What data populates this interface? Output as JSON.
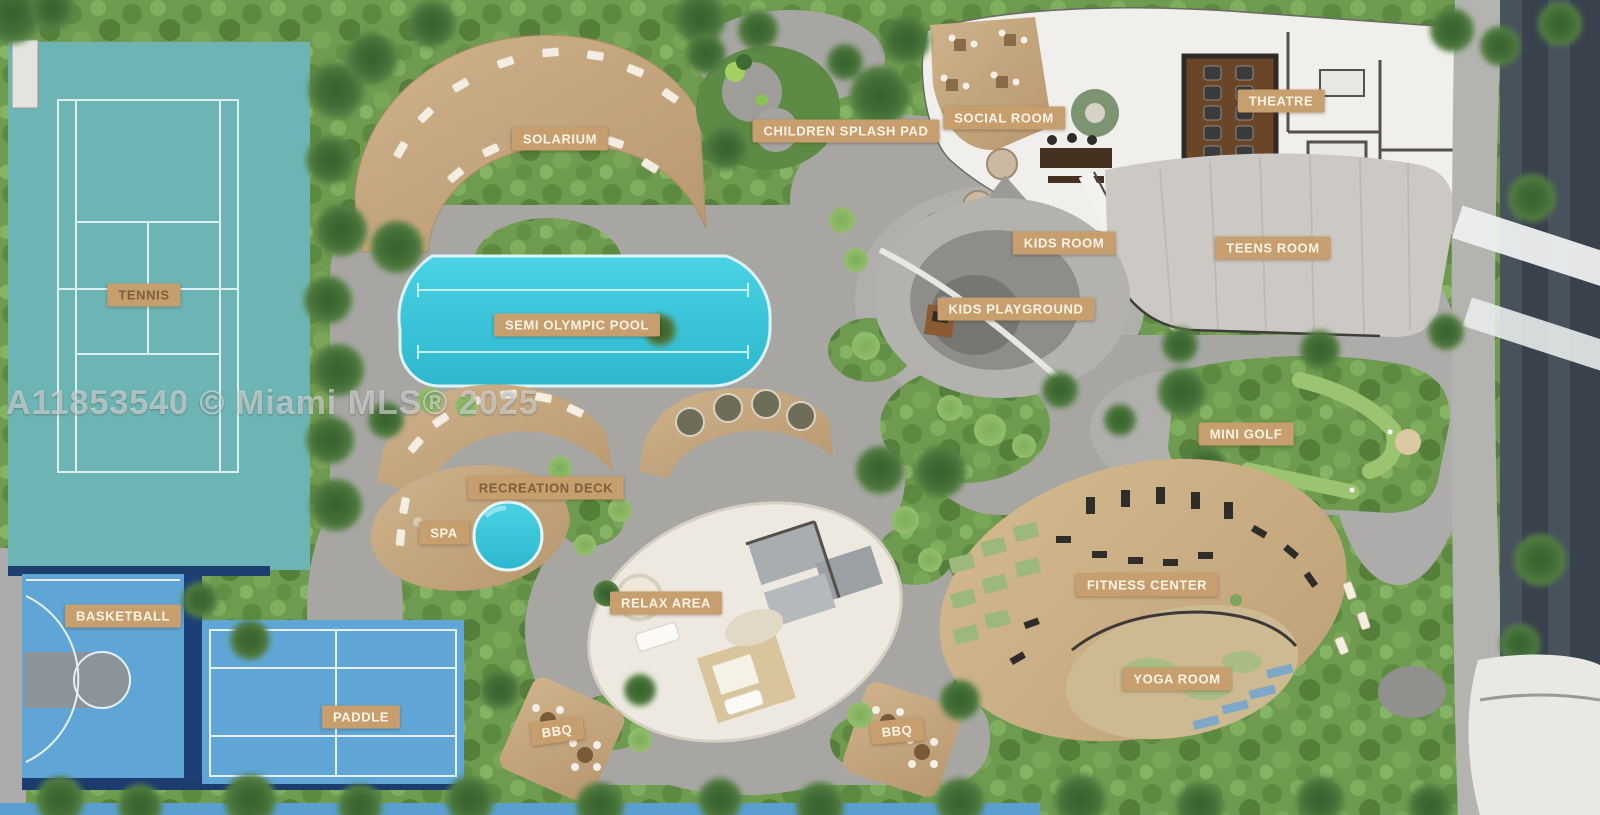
{
  "watermark": "A11853540 © Miami MLS® 2025",
  "plan": {
    "labels": {
      "tennis": "TENNIS",
      "solarium": "SOLARIUM",
      "children_splash_pad": "CHILDREN SPLASH PAD",
      "social_room": "SOCIAL ROOM",
      "theatre": "THEATRE",
      "kids_room": "KIDS ROOM",
      "teens_room": "TEENS ROOM",
      "kids_playground": "KIDS PLAYGROUND",
      "semi_olympic_pool": "SEMI OLYMPIC POOL",
      "mini_golf": "MINI GOLF",
      "recreation_deck": "RECREATION DECK",
      "spa": "SPA",
      "relax_area": "RELAX AREA",
      "fitness_center": "FITNESS CENTER",
      "basketball": "BASKETBALL",
      "yoga_room": "YOGA ROOM",
      "paddle": "PADDLE",
      "bbq_west": "BBQ",
      "bbq_east": "BBQ"
    },
    "colors": {
      "label_bg": "#c79e6d",
      "label_text": "#fbf4e6",
      "pool_cyan": "#3cc9de",
      "tennis_court": "#6db5b4",
      "sport_court_blue": "#5fa6d6",
      "court_navy": "#1d4079",
      "path_gray": "#a7a6a3",
      "foliage_green": "#6f9c50",
      "deck_wood": "#c4a47d",
      "building_white": "#f1efeb",
      "theatre_brown": "#6b4528"
    }
  }
}
